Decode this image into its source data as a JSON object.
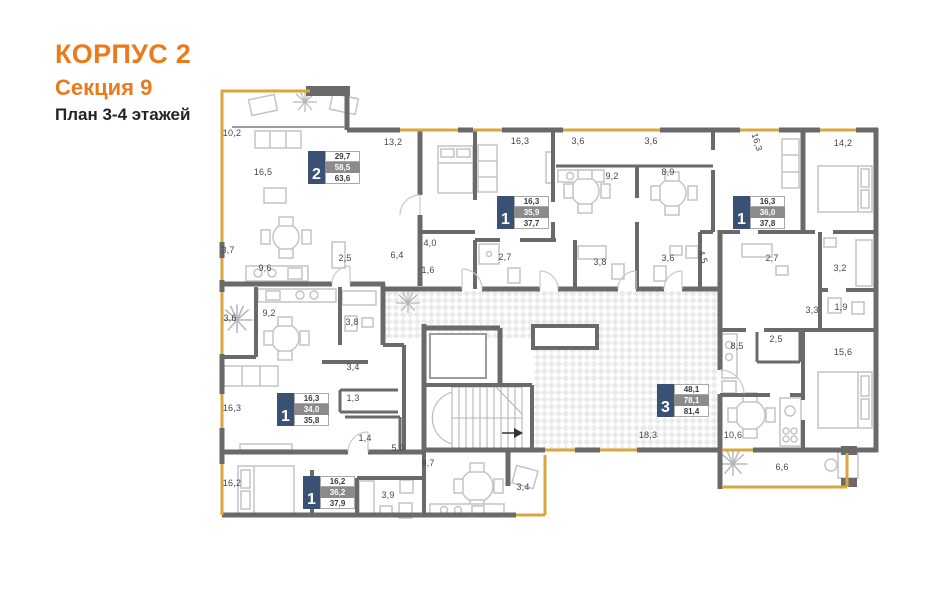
{
  "title": {
    "line1": "КОРПУС 2",
    "line2": "Секция 9",
    "line3": "План 3-4 этажей"
  },
  "colors": {
    "accent_orange": "#EB7A1A",
    "window_orange": "#D9A73E",
    "wall_gray": "#6A6A6A",
    "badge_navy": "#3A5174",
    "badge_gray_row": "#8B8B8B",
    "label_text": "#45454E"
  },
  "apartments": [
    {
      "rooms": "2",
      "living_area": "29,7",
      "area_excl_balcony": "58,5",
      "total_area": "63,6"
    },
    {
      "rooms": "1",
      "living_area": "16,3",
      "area_excl_balcony": "35,9",
      "total_area": "37,7"
    },
    {
      "rooms": "1",
      "living_area": "16,3",
      "area_excl_balcony": "36,0",
      "total_area": "37,8"
    },
    {
      "rooms": "1",
      "living_area": "16,3",
      "area_excl_balcony": "34,0",
      "total_area": "35,8"
    },
    {
      "rooms": "3",
      "living_area": "48,1",
      "area_excl_balcony": "78,1",
      "total_area": "81,4"
    },
    {
      "rooms": "1",
      "living_area": "16,2",
      "area_excl_balcony": "36,2",
      "total_area": "37,9"
    }
  ],
  "room_labels": [
    {
      "text": "10,2",
      "x": 232,
      "y": 133
    },
    {
      "text": "16,5",
      "x": 263,
      "y": 172
    },
    {
      "text": "13,2",
      "x": 393,
      "y": 142
    },
    {
      "text": "16,3",
      "x": 520,
      "y": 141
    },
    {
      "text": "3,6",
      "x": 578,
      "y": 141
    },
    {
      "text": "3,6",
      "x": 651,
      "y": 141
    },
    {
      "text": "16,3",
      "x": 757,
      "y": 142,
      "rot": true
    },
    {
      "text": "14,2",
      "x": 843,
      "y": 143
    },
    {
      "text": "9,2",
      "x": 612,
      "y": 176
    },
    {
      "text": "8,9",
      "x": 668,
      "y": 172
    },
    {
      "text": "3,7",
      "x": 228,
      "y": 250
    },
    {
      "text": "9,6",
      "x": 265,
      "y": 268
    },
    {
      "text": "2,5",
      "x": 345,
      "y": 258
    },
    {
      "text": "6,4",
      "x": 397,
      "y": 255
    },
    {
      "text": "4,0",
      "x": 430,
      "y": 243
    },
    {
      "text": "1,6",
      "x": 428,
      "y": 270
    },
    {
      "text": "2,7",
      "x": 505,
      "y": 257
    },
    {
      "text": "3,8",
      "x": 600,
      "y": 262
    },
    {
      "text": "3,6",
      "x": 668,
      "y": 258
    },
    {
      "text": "4,5",
      "x": 703,
      "y": 257,
      "rot": true
    },
    {
      "text": "2,7",
      "x": 772,
      "y": 258
    },
    {
      "text": "3,2",
      "x": 840,
      "y": 268
    },
    {
      "text": "3,3",
      "x": 812,
      "y": 310
    },
    {
      "text": "1,9",
      "x": 841,
      "y": 307
    },
    {
      "text": "3,6",
      "x": 230,
      "y": 318
    },
    {
      "text": "9,2",
      "x": 269,
      "y": 313
    },
    {
      "text": "3,8",
      "x": 352,
      "y": 322
    },
    {
      "text": "3,4",
      "x": 353,
      "y": 367
    },
    {
      "text": "1,3",
      "x": 353,
      "y": 398
    },
    {
      "text": "16,3",
      "x": 232,
      "y": 408
    },
    {
      "text": "1,4",
      "x": 365,
      "y": 438
    },
    {
      "text": "5,0",
      "x": 398,
      "y": 448
    },
    {
      "text": "9,7",
      "x": 428,
      "y": 463
    },
    {
      "text": "18,3",
      "x": 648,
      "y": 435
    },
    {
      "text": "8,5",
      "x": 737,
      "y": 346
    },
    {
      "text": "2,5",
      "x": 776,
      "y": 339
    },
    {
      "text": "15,6",
      "x": 843,
      "y": 352
    },
    {
      "text": "10,6",
      "x": 733,
      "y": 435
    },
    {
      "text": "6,6",
      "x": 782,
      "y": 467
    },
    {
      "text": "16,2",
      "x": 232,
      "y": 483
    },
    {
      "text": "3,9",
      "x": 388,
      "y": 495
    },
    {
      "text": "3,4",
      "x": 523,
      "y": 487
    }
  ]
}
